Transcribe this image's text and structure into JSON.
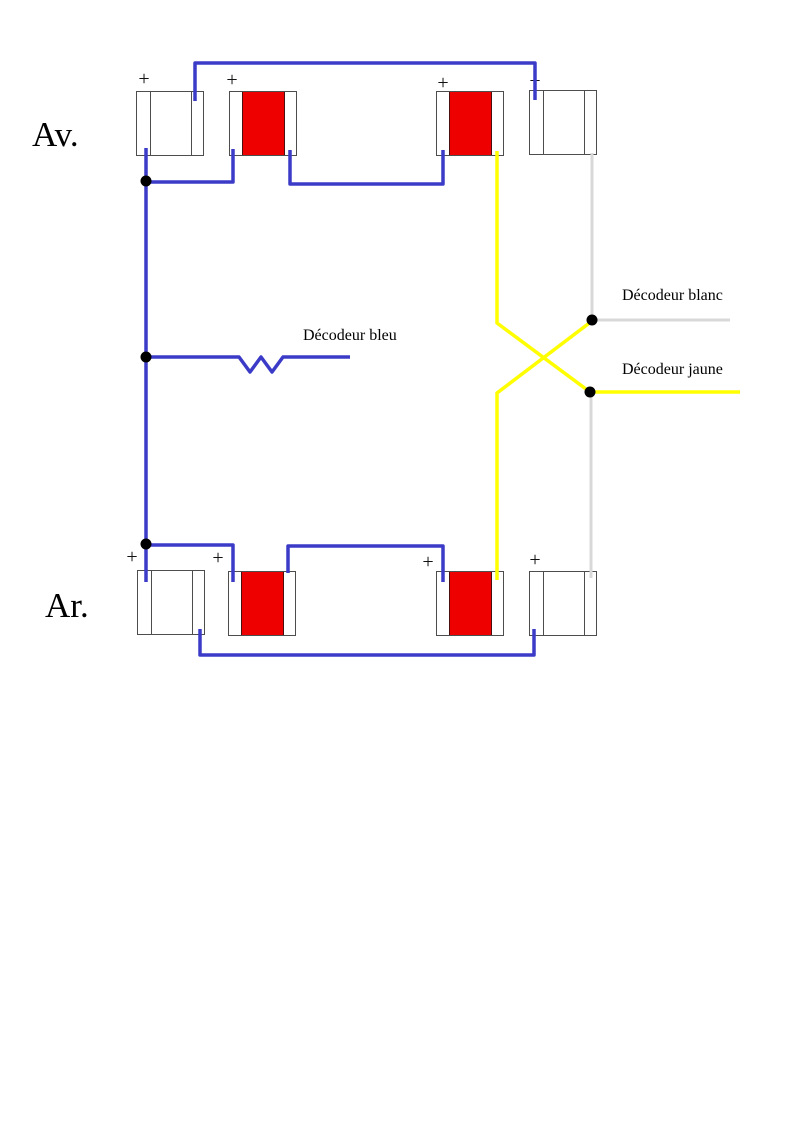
{
  "diagram": {
    "front_label": "Av.",
    "rear_label": "Ar.",
    "polarity_mark": "+",
    "decoder_blue_label": "Décodeur bleu",
    "decoder_white_label": "Décodeur blanc",
    "decoder_yellow_label": "Décodeur jaune"
  },
  "colors": {
    "wire_blue": "#3b3bc8",
    "wire_yellow": "#ffff00",
    "wire_gray": "#d8d8d8",
    "lamp_red": "#ee0000",
    "lamp_border": "#4d4d4d",
    "junction_dot": "#000000",
    "text": "#000000"
  }
}
